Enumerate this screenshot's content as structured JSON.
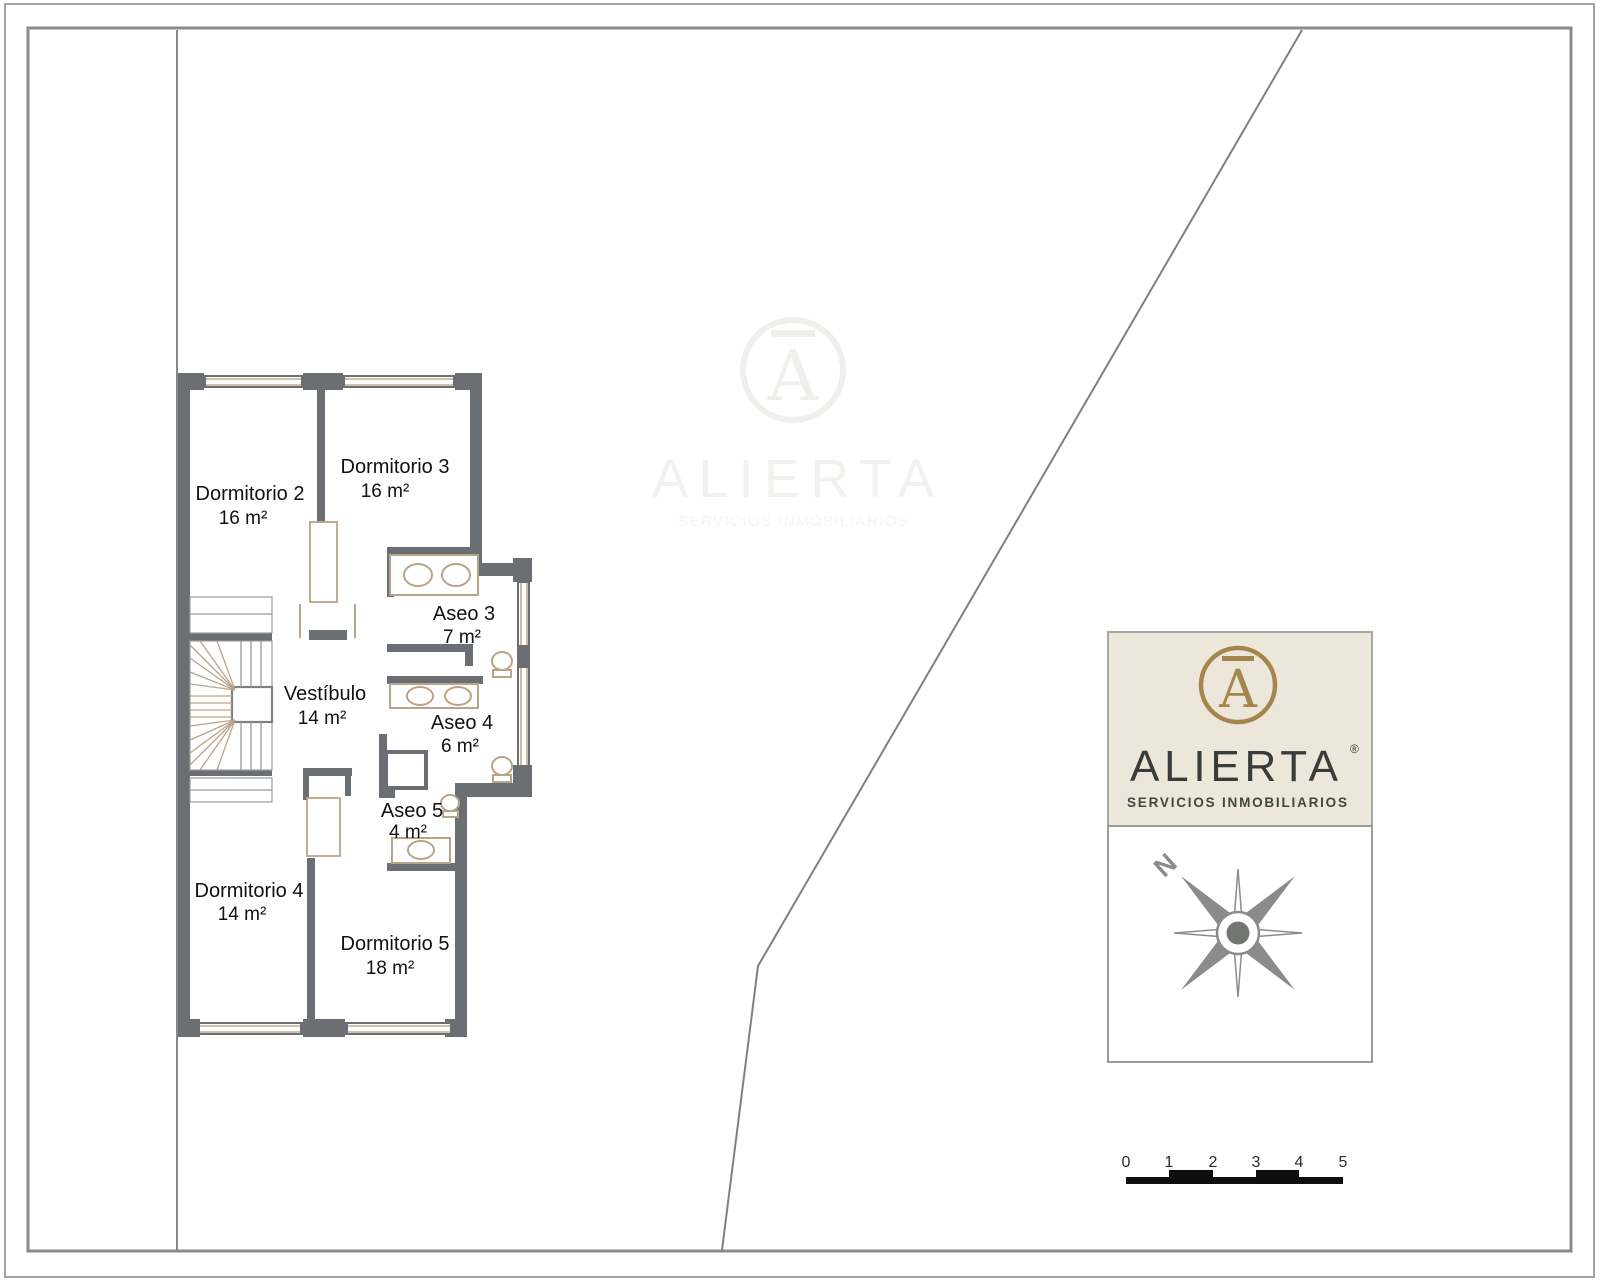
{
  "floor_plan": {
    "rooms": [
      {
        "name": "Dormitorio 2",
        "area": "16 m²"
      },
      {
        "name": "Dormitorio 3",
        "area": "16 m²"
      },
      {
        "name": "Aseo 3",
        "area": "7 m²"
      },
      {
        "name": "Vestíbulo",
        "area": "14 m²"
      },
      {
        "name": "Aseo 4",
        "area": "6 m²"
      },
      {
        "name": "Aseo 5",
        "area": "4 m²"
      },
      {
        "name": "Dormitorio 4",
        "area": "14 m²"
      },
      {
        "name": "Dormitorio 5",
        "area": "18 m²"
      }
    ],
    "colors": {
      "wall": "#6b6e73",
      "window": "#c1aa8e",
      "fixture": "#b9a489",
      "text": "#111111",
      "boundary": "#85878a"
    }
  },
  "sign": {
    "brand": "ALIERTA",
    "registered": "®",
    "tagline": "SERVICIOS INMOBILIARIOS",
    "monogram": "A",
    "colors": {
      "panel": "#ece7da",
      "gold": "#a5854c",
      "text": "#3b3b39"
    }
  },
  "watermark": {
    "brand": "ALIERTA",
    "tagline": "SERVICIOS INMOBILIARIOS",
    "monogram": "A"
  },
  "compass": {
    "north": "N"
  },
  "scale_bar": {
    "ticks": [
      "0",
      "1",
      "2",
      "3",
      "4",
      "5"
    ]
  }
}
